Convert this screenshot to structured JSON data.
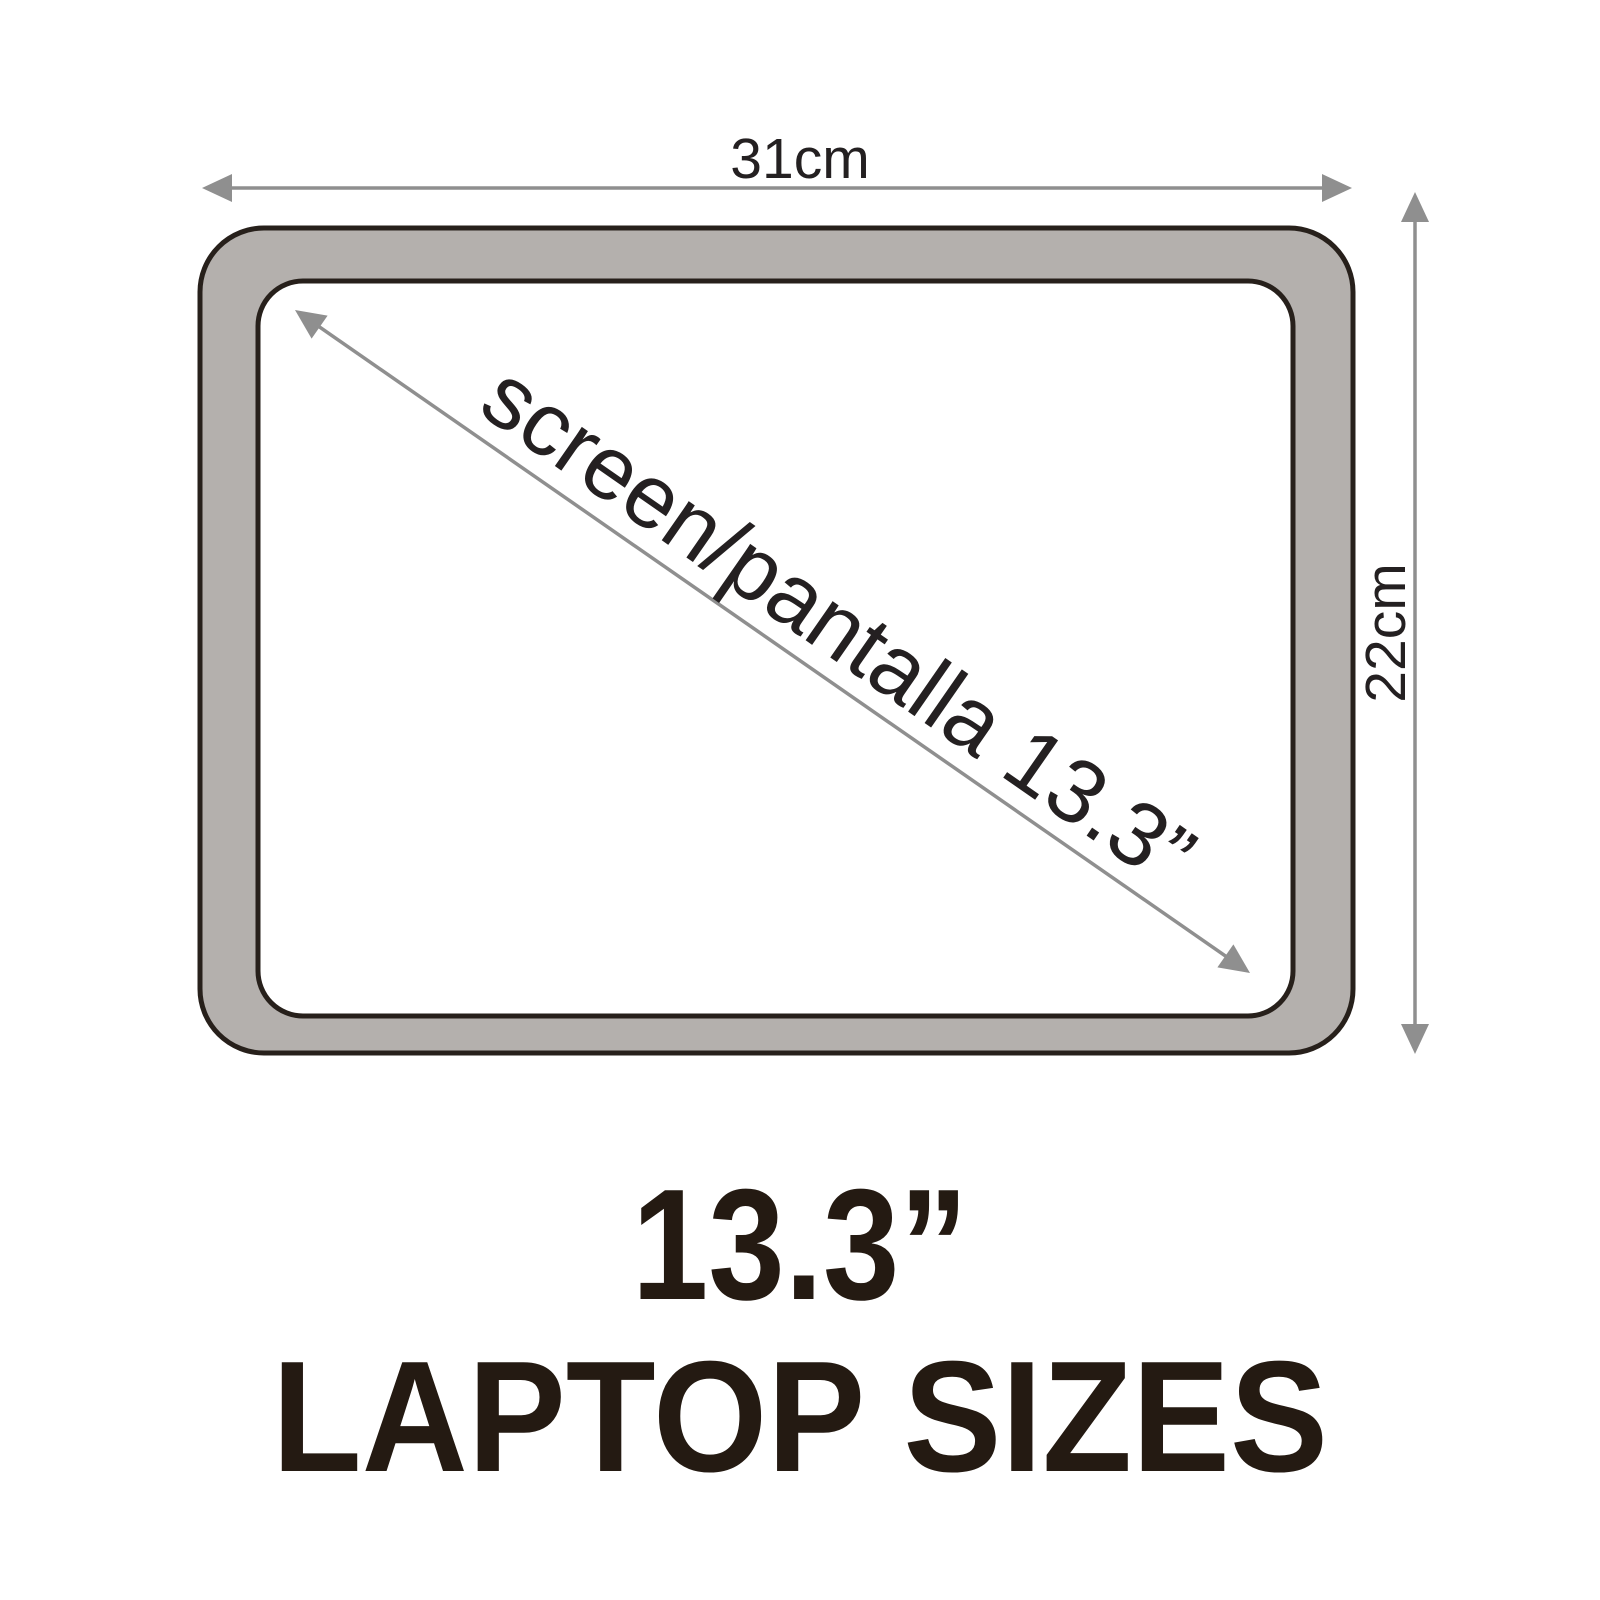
{
  "laptop": {
    "width_label": "31cm",
    "height_label": "22cm",
    "diagonal_label": "screen/pantalla 13.3”"
  },
  "caption": {
    "size_value": "13.3”",
    "title": "LAPTOP SIZES"
  },
  "colors": {
    "bezel_gray": "#b4b0ad",
    "outline_dark": "#27201b",
    "arrow_gray": "#8f8f8f",
    "label_text": "#242021",
    "caption_text": "#241a12",
    "background": "#ffffff"
  }
}
